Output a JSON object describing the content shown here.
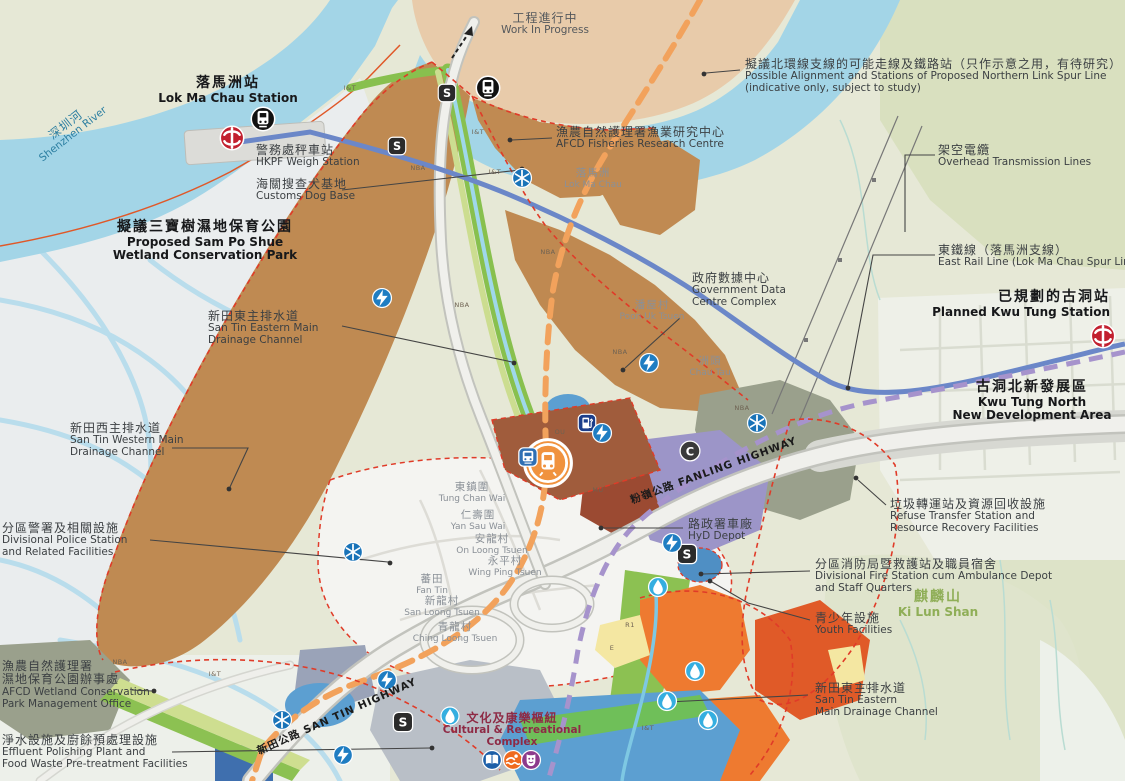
{
  "map_name": "San Tin Technopole development plan map",
  "colors": {
    "river": "#a3d5e7",
    "wetland": "#eaedee",
    "land_olive": "#e6e8d6",
    "work_in_progress_land": "#e8cbaa",
    "it_parcel_brown": "#bf8a52",
    "station_block": "#a05c3c",
    "boundary_red_dash": "#e03b28",
    "spur_line_orange_dash": "#f2a25c",
    "rail_purple_dash": "#a693cc",
    "east_rail_blue": "#6b87c8",
    "drainage_green": "#88c04e",
    "hyd_purple": "#9c95c8",
    "orange_parcel": "#ee7a30",
    "mtr_red": "#c2202f",
    "icon_blue": "#1f7dc2",
    "droplet_cyan": "#35aee0"
  },
  "glyphs": {
    "s_badge": "S",
    "interchange": "C"
  },
  "labels": [
    {
      "id": "work-in-progress",
      "x": 545,
      "y": 12,
      "align": "center",
      "color": "#54585c",
      "lines": [
        "工程進行中",
        "Work In Progress"
      ]
    },
    {
      "id": "northern-link-note",
      "x": 745,
      "y": 58,
      "align": "left",
      "color": "#3c4043",
      "lines": [
        "擬議北環線支線的可能走線及鐵路站（只作示意之用，有待研究）",
        "Possible Alignment and Stations of Proposed Northern Link Spur Line",
        "(indicative only, subject to study)"
      ]
    },
    {
      "id": "lok-ma-chau-station",
      "x": 228,
      "y": 76,
      "align": "center",
      "bold": true,
      "cls": "big",
      "color": "#17181a",
      "lines": [
        "落馬洲站",
        "Lok Ma Chau Station"
      ]
    },
    {
      "id": "shenzhen-river",
      "x": 62,
      "y": 120,
      "align": "center",
      "rotate": -38,
      "color": "#2b7ea1",
      "lines": [
        "深圳河",
        "Shenzhen River"
      ]
    },
    {
      "id": "hkpf-weigh-station",
      "x": 256,
      "y": 144,
      "align": "left",
      "color": "#3c4043",
      "lines": [
        "警務處秤車站",
        "HKPF Weigh Station"
      ]
    },
    {
      "id": "customs-dog-base",
      "x": 256,
      "y": 178,
      "align": "left",
      "color": "#3c4043",
      "lines": [
        "海關搜查犬基地",
        "Customs Dog Base"
      ]
    },
    {
      "id": "afcd-fisheries-research-centre",
      "x": 556,
      "y": 126,
      "align": "left",
      "color": "#3c4043",
      "lines": [
        "漁農自然護理署漁業研究中心",
        "AFCD Fisheries Research Centre"
      ]
    },
    {
      "id": "lok-ma-chau-placename",
      "x": 593,
      "y": 168,
      "align": "center",
      "cls": "small",
      "color": "#8a9097",
      "lines": [
        "落馬洲",
        "Lok Ma Chau"
      ]
    },
    {
      "id": "overhead-transmission-lines",
      "x": 938,
      "y": 144,
      "align": "left",
      "color": "#3c4043",
      "lines": [
        "架空電纜",
        "Overhead Transmission Lines"
      ]
    },
    {
      "id": "east-rail-line",
      "x": 938,
      "y": 244,
      "align": "left",
      "color": "#3c4043",
      "lines": [
        "東鐵線（落馬洲支線）",
        "East Rail Line (Lok Ma Chau Spur Line)"
      ]
    },
    {
      "id": "sam-po-shue-park",
      "x": 205,
      "y": 220,
      "align": "center",
      "bold": true,
      "cls": "big",
      "color": "#17181a",
      "lines": [
        "擬議三寶樹濕地保育公園",
        "Proposed Sam Po Shue",
        "Wetland Conservation Park"
      ]
    },
    {
      "id": "govt-data-centre",
      "x": 692,
      "y": 272,
      "align": "left",
      "color": "#3c4043",
      "lines": [
        "政府數據中心",
        "Government Data",
        "Centre Complex"
      ]
    },
    {
      "id": "planned-kwu-tung-station",
      "x": 1110,
      "y": 290,
      "align": "right",
      "bold": true,
      "cls": "big",
      "color": "#17181a",
      "lines": [
        "已規劃的古洞站",
        "Planned Kwu Tung Station"
      ]
    },
    {
      "id": "poon-uk-tsuen",
      "x": 652,
      "y": 300,
      "align": "center",
      "cls": "small",
      "color": "#8a9097",
      "lines": [
        "潘屋村",
        "Poon Uk Tsuen"
      ]
    },
    {
      "id": "san-tin-eastern-drainage-1",
      "x": 208,
      "y": 310,
      "align": "left",
      "color": "#3c4043",
      "lines": [
        "新田東主排水道",
        "San Tin Eastern Main",
        "Drainage Channel"
      ]
    },
    {
      "id": "chau-tau",
      "x": 710,
      "y": 356,
      "align": "center",
      "cls": "small",
      "color": "#8a9097",
      "lines": [
        "洲頭",
        "Chau Tau"
      ]
    },
    {
      "id": "kwu-tung-north-nda",
      "x": 1032,
      "y": 380,
      "align": "center",
      "bold": true,
      "cls": "big",
      "color": "#17181a",
      "lines": [
        "古洞北新發展區",
        "Kwu Tung North",
        "New Development Area"
      ]
    },
    {
      "id": "san-tin-western-drainage",
      "x": 70,
      "y": 422,
      "align": "left",
      "color": "#3c4043",
      "lines": [
        "新田西主排水道",
        "San Tin Western Main",
        "Drainage Channel"
      ]
    },
    {
      "id": "fanling-highway",
      "x": 712,
      "y": 466,
      "align": "center",
      "rotate": -20,
      "cls": "road",
      "color": "#1b1b1b",
      "lines": [
        "粉嶺公路 FANLING HIGHWAY"
      ]
    },
    {
      "id": "divisional-police-station",
      "x": 2,
      "y": 522,
      "align": "left",
      "color": "#3c4043",
      "lines": [
        "分區警署及相關設施",
        "Divisional Police Station",
        "and Related Facilities"
      ]
    },
    {
      "id": "refuse-transfer-station",
      "x": 890,
      "y": 498,
      "align": "left",
      "color": "#3c4043",
      "lines": [
        "垃圾轉運站及資源回收設施",
        "Refuse Transfer Station and",
        "Resource Recovery Facilities"
      ]
    },
    {
      "id": "hyd-depot",
      "x": 688,
      "y": 518,
      "align": "left",
      "color": "#3c4043",
      "lines": [
        "路政署車廠",
        "HyD Depot"
      ]
    },
    {
      "id": "divisional-fire-station",
      "x": 815,
      "y": 558,
      "align": "left",
      "color": "#3c4043",
      "lines": [
        "分區消防局暨救護站及職員宿舍",
        "Divisional Fire Station cum Ambulance Depot",
        "and Staff Quarters"
      ]
    },
    {
      "id": "youth-facilities",
      "x": 815,
      "y": 612,
      "align": "left",
      "color": "#3c4043",
      "lines": [
        "青少年設施",
        "Youth Facilities"
      ]
    },
    {
      "id": "ki-lun-shan",
      "x": 938,
      "y": 590,
      "align": "center",
      "bold": true,
      "cls": "big",
      "color": "#8fae57",
      "lines": [
        "麒麟山",
        "Ki Lun Shan"
      ]
    },
    {
      "id": "tung-chan-wai",
      "x": 472,
      "y": 482,
      "align": "center",
      "cls": "small",
      "color": "#8a9097",
      "lines": [
        "東鎮圍",
        "Tung Chan Wai"
      ]
    },
    {
      "id": "yan-sau-wai",
      "x": 478,
      "y": 510,
      "align": "center",
      "cls": "small",
      "color": "#8a9097",
      "lines": [
        "仁壽圍",
        "Yan Sau Wai"
      ]
    },
    {
      "id": "on-loong-tsuen",
      "x": 492,
      "y": 534,
      "align": "center",
      "cls": "small",
      "color": "#8a9097",
      "lines": [
        "安龍村",
        "On Loong Tsuen"
      ]
    },
    {
      "id": "wing-ping-tsuen",
      "x": 505,
      "y": 556,
      "align": "center",
      "cls": "small",
      "color": "#8a9097",
      "lines": [
        "永平村",
        "Wing Ping Tsuen"
      ]
    },
    {
      "id": "fan-tin",
      "x": 432,
      "y": 574,
      "align": "center",
      "cls": "small",
      "color": "#8a9097",
      "lines": [
        "蕃田",
        "Fan Tin"
      ]
    },
    {
      "id": "san-loong-tsuen",
      "x": 442,
      "y": 596,
      "align": "center",
      "cls": "small",
      "color": "#8a9097",
      "lines": [
        "新龍村",
        "San Loong Tsuen"
      ]
    },
    {
      "id": "ching-loong-tsuen",
      "x": 455,
      "y": 622,
      "align": "center",
      "cls": "small",
      "color": "#8a9097",
      "lines": [
        "青龍村",
        "Ching Loong Tsuen"
      ]
    },
    {
      "id": "afcd-wetland-park-office",
      "x": 2,
      "y": 660,
      "align": "left",
      "color": "#3c4043",
      "lines": [
        "漁農自然護理署",
        "濕地保育公園辦事處",
        "AFCD Wetland Conservation",
        "Park Management Office"
      ]
    },
    {
      "id": "effluent-polishing-plant",
      "x": 2,
      "y": 734,
      "align": "left",
      "color": "#3c4043",
      "lines": [
        "淨水設施及廚餘預處理設施",
        "Effluent Polishing Plant and",
        "Food Waste Pre-treatment Facilities"
      ]
    },
    {
      "id": "san-tin-highway",
      "x": 335,
      "y": 712,
      "align": "center",
      "rotate": -24,
      "cls": "road",
      "color": "#1b1b1b",
      "lines": [
        "新田公路 SAN TIN HIGHWAY"
      ]
    },
    {
      "id": "cultural-recreational-complex",
      "x": 512,
      "y": 712,
      "align": "center",
      "bold": true,
      "color": "#8e2a45",
      "lines": [
        "文化及康樂樞紐",
        "Cultural & Recreational",
        "Complex"
      ]
    },
    {
      "id": "san-tin-eastern-drainage-2",
      "x": 815,
      "y": 682,
      "align": "left",
      "color": "#3c4043",
      "lines": [
        "新田東主排水道",
        "San Tin Eastern",
        "Main Drainage Channel"
      ]
    }
  ],
  "parcel_codes": [
    {
      "t": "I&T",
      "x": 350,
      "y": 88
    },
    {
      "t": "NBA",
      "x": 418,
      "y": 168
    },
    {
      "t": "I&T",
      "x": 478,
      "y": 132
    },
    {
      "t": "I&T",
      "x": 495,
      "y": 172
    },
    {
      "t": "NBA",
      "x": 548,
      "y": 252
    },
    {
      "t": "NBA",
      "x": 462,
      "y": 305
    },
    {
      "t": "NBA",
      "x": 620,
      "y": 352
    },
    {
      "t": "NBA",
      "x": 742,
      "y": 408
    },
    {
      "t": "MU",
      "x": 598,
      "y": 490
    },
    {
      "t": "OU",
      "x": 560,
      "y": 432
    },
    {
      "t": "R1",
      "x": 630,
      "y": 625
    },
    {
      "t": "E",
      "x": 612,
      "y": 648
    },
    {
      "t": "NBA",
      "x": 120,
      "y": 662
    },
    {
      "t": "I&T",
      "x": 215,
      "y": 674
    },
    {
      "t": "I&T",
      "x": 648,
      "y": 728
    },
    {
      "t": "I&T",
      "x": 863,
      "y": 687
    }
  ],
  "icons": [
    {
      "type": "mtr",
      "x": 232,
      "y": 140,
      "size": 26
    },
    {
      "type": "mtr",
      "x": 1103,
      "y": 338,
      "size": 26
    },
    {
      "type": "station",
      "x": 263,
      "y": 121,
      "size": 26
    },
    {
      "type": "station",
      "x": 488,
      "y": 90,
      "size": 26
    },
    {
      "type": "s_badge",
      "x": 447,
      "y": 95,
      "size": 20
    },
    {
      "type": "s_badge",
      "x": 397,
      "y": 148,
      "size": 20
    },
    {
      "type": "s_badge",
      "x": 687,
      "y": 556,
      "size": 22
    },
    {
      "type": "s_badge",
      "x": 403,
      "y": 724,
      "size": 22
    },
    {
      "type": "interchange",
      "x": 690,
      "y": 453,
      "size": 22
    },
    {
      "type": "proposed_station",
      "x": 548,
      "y": 465,
      "size": 52
    },
    {
      "type": "bus",
      "x": 528,
      "y": 459,
      "size": 21
    },
    {
      "type": "fuel",
      "x": 587,
      "y": 425,
      "size": 20
    },
    {
      "type": "lightning",
      "x": 382,
      "y": 300,
      "size": 21
    },
    {
      "type": "lightning",
      "x": 649,
      "y": 365,
      "size": 21
    },
    {
      "type": "lightning",
      "x": 602,
      "y": 435,
      "size": 21
    },
    {
      "type": "lightning",
      "x": 672,
      "y": 545,
      "size": 21
    },
    {
      "type": "lightning",
      "x": 387,
      "y": 682,
      "size": 21
    },
    {
      "type": "lightning",
      "x": 343,
      "y": 757,
      "size": 21
    },
    {
      "type": "snowflake",
      "x": 522,
      "y": 180,
      "size": 21
    },
    {
      "type": "snowflake",
      "x": 353,
      "y": 554,
      "size": 21
    },
    {
      "type": "snowflake",
      "x": 757,
      "y": 425,
      "size": 21
    },
    {
      "type": "snowflake",
      "x": 282,
      "y": 722,
      "size": 21
    },
    {
      "type": "droplet",
      "x": 658,
      "y": 589,
      "size": 21
    },
    {
      "type": "droplet",
      "x": 695,
      "y": 673,
      "size": 21
    },
    {
      "type": "droplet",
      "x": 667,
      "y": 703,
      "size": 21
    },
    {
      "type": "droplet",
      "x": 708,
      "y": 722,
      "size": 21
    },
    {
      "type": "droplet",
      "x": 450,
      "y": 718,
      "size": 20
    },
    {
      "type": "book",
      "x": 492,
      "y": 762,
      "size": 21
    },
    {
      "type": "swim",
      "x": 513,
      "y": 762,
      "size": 21
    },
    {
      "type": "theatre",
      "x": 531,
      "y": 762,
      "size": 21
    }
  ]
}
